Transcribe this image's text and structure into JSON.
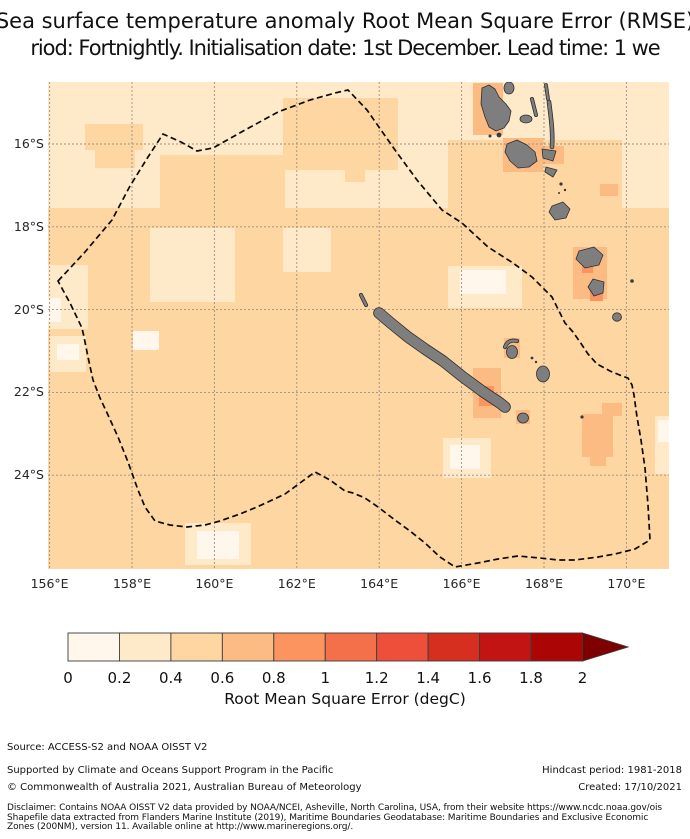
{
  "title": {
    "line1": "Sea surface temperature anomaly Root Mean Square Error (RMSE)",
    "line2": "riod: Fortnightly. Initialisation date: 1st December. Lead time: 1 we"
  },
  "colorbar": {
    "label": "Root Mean Square Error (degC)",
    "tick_labels": [
      "0",
      "0.2",
      "0.4",
      "0.6",
      "0.8",
      "1",
      "1.2",
      "1.4",
      "1.6",
      "1.8",
      "2"
    ],
    "colors": [
      "#fff7ec",
      "#fee9c9",
      "#fdd6a2",
      "#fdbb84",
      "#fc9460",
      "#f4704b",
      "#ee4f3a",
      "#d62f20",
      "#c11413",
      "#ab0605"
    ],
    "over_color": "#7f0000",
    "extend": "max"
  },
  "footer": {
    "source": "Source: ACCESS-S2 and NOAA OISST V2",
    "supported": "Supported by Climate and Oceans Support Program in the Pacific",
    "copyright": "© Commonwealth of Australia 2021, Australian Bureau of Meteorology",
    "hindcast": "Hindcast period: 1981-2018",
    "created": "Created: 17/10/2021",
    "disclaimer_line1": "Disclaimer: Contains NOAA OISST V2 data provided by NOAA/NCEI, Asheville, North Carolina, USA, from their website https://www.ncdc.noaa.gov/ois",
    "disclaimer_line2": "Shapefile data extracted from Flanders Marine Institute (2019), Maritime Boundaries Geodatabase: Maritime Boundaries and Exclusive Economic",
    "disclaimer_line3": "Zones (200NM), version 11. Available online at http://www.marineregions.org/."
  },
  "chart_data": {
    "type": "heatmap",
    "subtype": "geographic filled-contour RMSE map with dashed EEZ boundary and gray islands",
    "x_tick_labels": [
      "156°E",
      "158°E",
      "160°E",
      "162°E",
      "164°E",
      "166°E",
      "168°E",
      "170°E"
    ],
    "y_tick_labels": [
      "16°S",
      "18°S",
      "20°S",
      "22°S",
      "24°S"
    ],
    "lon_tick_x_px": [
      49.6,
      132,
      214.4,
      296.8,
      379.2,
      461.6,
      544,
      626.4
    ],
    "lat_tick_y_px": [
      144,
      226.8,
      309.6,
      392.4,
      475.2
    ],
    "map_px": {
      "x": 48,
      "y": 82,
      "w": 621,
      "h": 487
    },
    "value_bins_degC": [
      "0-0.2",
      "0.2-0.4",
      "0.4-0.6",
      "0.6-0.8",
      "0.8-1.0",
      "1.0-1.2",
      "1.2-1.4",
      "1.4-1.6",
      "1.6-1.8",
      "1.8-2.0"
    ],
    "base_bins": {
      "north": "0.2-0.4",
      "south": "0.4-0.6"
    },
    "patches": [
      {
        "c": 2,
        "r": [
          48,
          208,
          621,
          361
        ]
      },
      {
        "c": 2,
        "r": [
          85,
          124,
          58,
          26
        ]
      },
      {
        "c": 2,
        "r": [
          95,
          150,
          40,
          18
        ]
      },
      {
        "c": 2,
        "r": [
          283,
          98,
          115,
          72
        ]
      },
      {
        "c": 2,
        "r": [
          448,
          140,
          174,
          70
        ]
      },
      {
        "c": 2,
        "r": [
          160,
          155,
          125,
          58
        ]
      },
      {
        "c": 2,
        "r": [
          345,
          150,
          20,
          32
        ]
      },
      {
        "c": 1,
        "r": [
          150,
          228,
          85,
          74
        ]
      },
      {
        "c": 1,
        "r": [
          283,
          228,
          48,
          44
        ]
      },
      {
        "c": 1,
        "r": [
          48,
          265,
          40,
          64
        ]
      },
      {
        "c": 1,
        "r": [
          50,
          336,
          36,
          36
        ]
      },
      {
        "c": 1,
        "r": [
          448,
          266,
          74,
          42
        ]
      },
      {
        "c": 1,
        "r": [
          443,
          438,
          48,
          40
        ]
      },
      {
        "c": 1,
        "r": [
          185,
          523,
          66,
          42
        ]
      },
      {
        "c": 1,
        "r": [
          655,
          416,
          14,
          58
        ]
      },
      {
        "c": 0,
        "r": [
          57,
          344,
          22,
          16
        ]
      },
      {
        "c": 0,
        "r": [
          133,
          331,
          26,
          19
        ]
      },
      {
        "c": 0,
        "r": [
          197,
          531,
          42,
          28
        ]
      },
      {
        "c": 0,
        "r": [
          460,
          270,
          46,
          24
        ]
      },
      {
        "c": 0,
        "r": [
          450,
          445,
          30,
          24
        ]
      },
      {
        "c": 0,
        "r": [
          658,
          420,
          11,
          22
        ]
      },
      {
        "c": 0,
        "r": [
          48,
          298,
          13,
          24
        ]
      },
      {
        "c": 3,
        "r": [
          473,
          83,
          30,
          52
        ]
      },
      {
        "c": 3,
        "r": [
          503,
          138,
          40,
          34
        ]
      },
      {
        "c": 3,
        "r": [
          542,
          146,
          22,
          18
        ]
      },
      {
        "c": 3,
        "r": [
          573,
          247,
          34,
          52
        ]
      },
      {
        "c": 3,
        "r": [
          602,
          403,
          20,
          13
        ]
      },
      {
        "c": 3,
        "r": [
          582,
          414,
          31,
          43
        ]
      },
      {
        "c": 3,
        "r": [
          590,
          457,
          16,
          9
        ]
      },
      {
        "c": 3,
        "r": [
          473,
          368,
          28,
          50
        ]
      },
      {
        "c": 3,
        "r": [
          600,
          184,
          18,
          12
        ]
      },
      {
        "c": 3,
        "r": [
          504,
          338,
          16,
          20
        ]
      },
      {
        "c": 3,
        "r": [
          516,
          410,
          14,
          14
        ]
      },
      {
        "c": 4,
        "r": [
          479,
          386,
          15,
          20
        ]
      },
      {
        "c": 4,
        "r": [
          582,
          260,
          11,
          13
        ]
      },
      {
        "c": 4,
        "r": [
          590,
          286,
          13,
          15
        ]
      }
    ],
    "eez_boundary_px": [
      [
        58,
        281
      ],
      [
        85,
        252
      ],
      [
        112,
        220
      ],
      [
        130,
        186
      ],
      [
        148,
        157
      ],
      [
        163,
        134
      ],
      [
        181,
        142
      ],
      [
        197,
        151
      ],
      [
        213,
        148
      ],
      [
        245,
        130
      ],
      [
        278,
        112
      ],
      [
        310,
        100
      ],
      [
        335,
        93
      ],
      [
        348,
        90
      ],
      [
        367,
        110
      ],
      [
        395,
        150
      ],
      [
        417,
        180
      ],
      [
        442,
        210
      ],
      [
        462,
        223
      ],
      [
        488,
        247
      ],
      [
        513,
        263
      ],
      [
        532,
        277
      ],
      [
        552,
        297
      ],
      [
        565,
        323
      ],
      [
        573,
        332
      ],
      [
        580,
        342
      ],
      [
        588,
        354
      ],
      [
        597,
        364
      ],
      [
        610,
        371
      ],
      [
        622,
        376
      ],
      [
        628,
        378
      ],
      [
        632,
        385
      ],
      [
        634,
        395
      ],
      [
        637,
        417
      ],
      [
        641,
        440
      ],
      [
        645,
        468
      ],
      [
        648,
        505
      ],
      [
        650,
        540
      ],
      [
        635,
        549
      ],
      [
        615,
        554
      ],
      [
        598,
        557
      ],
      [
        575,
        560
      ],
      [
        558,
        560
      ],
      [
        540,
        558
      ],
      [
        518,
        556
      ],
      [
        498,
        559
      ],
      [
        478,
        563
      ],
      [
        455,
        567
      ],
      [
        440,
        557
      ],
      [
        425,
        543
      ],
      [
        410,
        531
      ],
      [
        395,
        520
      ],
      [
        378,
        507
      ],
      [
        365,
        498
      ],
      [
        353,
        493
      ],
      [
        345,
        491
      ],
      [
        330,
        480
      ],
      [
        315,
        472
      ],
      [
        300,
        483
      ],
      [
        285,
        494
      ],
      [
        270,
        501
      ],
      [
        257,
        507
      ],
      [
        240,
        514
      ],
      [
        220,
        521
      ],
      [
        205,
        525
      ],
      [
        187,
        527
      ],
      [
        170,
        525
      ],
      [
        155,
        521
      ],
      [
        145,
        507
      ],
      [
        138,
        490
      ],
      [
        128,
        462
      ],
      [
        118,
        437
      ],
      [
        108,
        415
      ],
      [
        100,
        398
      ],
      [
        93,
        380
      ],
      [
        88,
        357
      ],
      [
        84,
        337
      ],
      [
        82,
        328
      ],
      [
        70,
        303
      ]
    ],
    "land_color": "#7e7e7e",
    "land_outline": "#2e2e2e",
    "land": [
      {
        "t": "path",
        "d": "M379,313 L392,324 L408,337 L425,349 L443,361 L463,377 L482,391 L500,403 L505,407",
        "w": 10
      },
      {
        "t": "path",
        "d": "M361,295 L366,305",
        "w": 2.5
      },
      {
        "t": "path",
        "d": "M505,347 Q508,339 517,341",
        "w": 2.5
      },
      {
        "t": "ell",
        "cx": 512,
        "cy": 352,
        "rx": 5.5,
        "ry": 6.5
      },
      {
        "t": "dot",
        "cx": 532,
        "cy": 358,
        "r": 1.4
      },
      {
        "t": "dot",
        "cx": 536,
        "cy": 362,
        "r": 1.2
      },
      {
        "t": "ell",
        "cx": 543,
        "cy": 374,
        "rx": 6.5,
        "ry": 8
      },
      {
        "t": "ell",
        "cx": 523,
        "cy": 418,
        "rx": 5.5,
        "ry": 5
      },
      {
        "t": "dot",
        "cx": 582,
        "cy": 417,
        "r": 1.6
      },
      {
        "t": "poly",
        "pts": [
          [
            482,
            88
          ],
          [
            489,
            85
          ],
          [
            495,
            89
          ],
          [
            499,
            97
          ],
          [
            506,
            104
          ],
          [
            511,
            111
          ],
          [
            509,
            121
          ],
          [
            504,
            128
          ],
          [
            496,
            131
          ],
          [
            489,
            127
          ],
          [
            485,
            117
          ],
          [
            481,
            104
          ]
        ]
      },
      {
        "t": "dot",
        "cx": 499,
        "cy": 135,
        "r": 2.4
      },
      {
        "t": "dot",
        "cx": 490,
        "cy": 136,
        "r": 1.5
      },
      {
        "t": "ell",
        "cx": 509,
        "cy": 88,
        "rx": 5,
        "ry": 6
      },
      {
        "t": "path",
        "d": "M546,85 L548,99",
        "w": 2.2
      },
      {
        "t": "path",
        "d": "M532,99 L536,115",
        "w": 2.4
      },
      {
        "t": "ell",
        "cx": 526,
        "cy": 119,
        "rx": 6,
        "ry": 4
      },
      {
        "t": "path",
        "d": "M549,102 C551,118 553,132 552,147",
        "w": 3
      },
      {
        "t": "poly",
        "pts": [
          [
            507,
            144
          ],
          [
            517,
            140
          ],
          [
            527,
            145
          ],
          [
            535,
            152
          ],
          [
            537,
            161
          ],
          [
            529,
            167
          ],
          [
            518,
            168
          ],
          [
            510,
            161
          ],
          [
            505,
            152
          ]
        ]
      },
      {
        "t": "poly",
        "pts": [
          [
            542,
            149
          ],
          [
            556,
            151
          ],
          [
            553,
            161
          ],
          [
            543,
            158
          ]
        ]
      },
      {
        "t": "poly",
        "pts": [
          [
            546,
            167
          ],
          [
            557,
            170
          ],
          [
            553,
            177
          ],
          [
            545,
            172
          ]
        ]
      },
      {
        "t": "dot",
        "cx": 561,
        "cy": 184,
        "r": 1.6
      },
      {
        "t": "dot",
        "cx": 565,
        "cy": 190,
        "r": 1.2
      },
      {
        "t": "dot",
        "cx": 559,
        "cy": 193,
        "r": 1
      },
      {
        "t": "poly",
        "pts": [
          [
            552,
            206
          ],
          [
            563,
            202
          ],
          [
            570,
            209
          ],
          [
            566,
            218
          ],
          [
            555,
            220
          ],
          [
            549,
            212
          ]
        ]
      },
      {
        "t": "poly",
        "pts": [
          [
            579,
            251
          ],
          [
            594,
            247
          ],
          [
            603,
            255
          ],
          [
            599,
            265
          ],
          [
            585,
            268
          ],
          [
            576,
            259
          ]
        ]
      },
      {
        "t": "poly",
        "pts": [
          [
            593,
            279
          ],
          [
            604,
            282
          ],
          [
            603,
            293
          ],
          [
            594,
            296
          ],
          [
            588,
            287
          ]
        ]
      },
      {
        "t": "dot",
        "cx": 632,
        "cy": 281,
        "r": 1.8
      },
      {
        "t": "ell",
        "cx": 617,
        "cy": 317,
        "rx": 4.5,
        "ry": 4.2
      }
    ],
    "colorbar_geom": {
      "x": 68,
      "y": 633,
      "seg_w": 51.45,
      "h": 28,
      "tip_x": 628,
      "tick_y": 683
    }
  }
}
